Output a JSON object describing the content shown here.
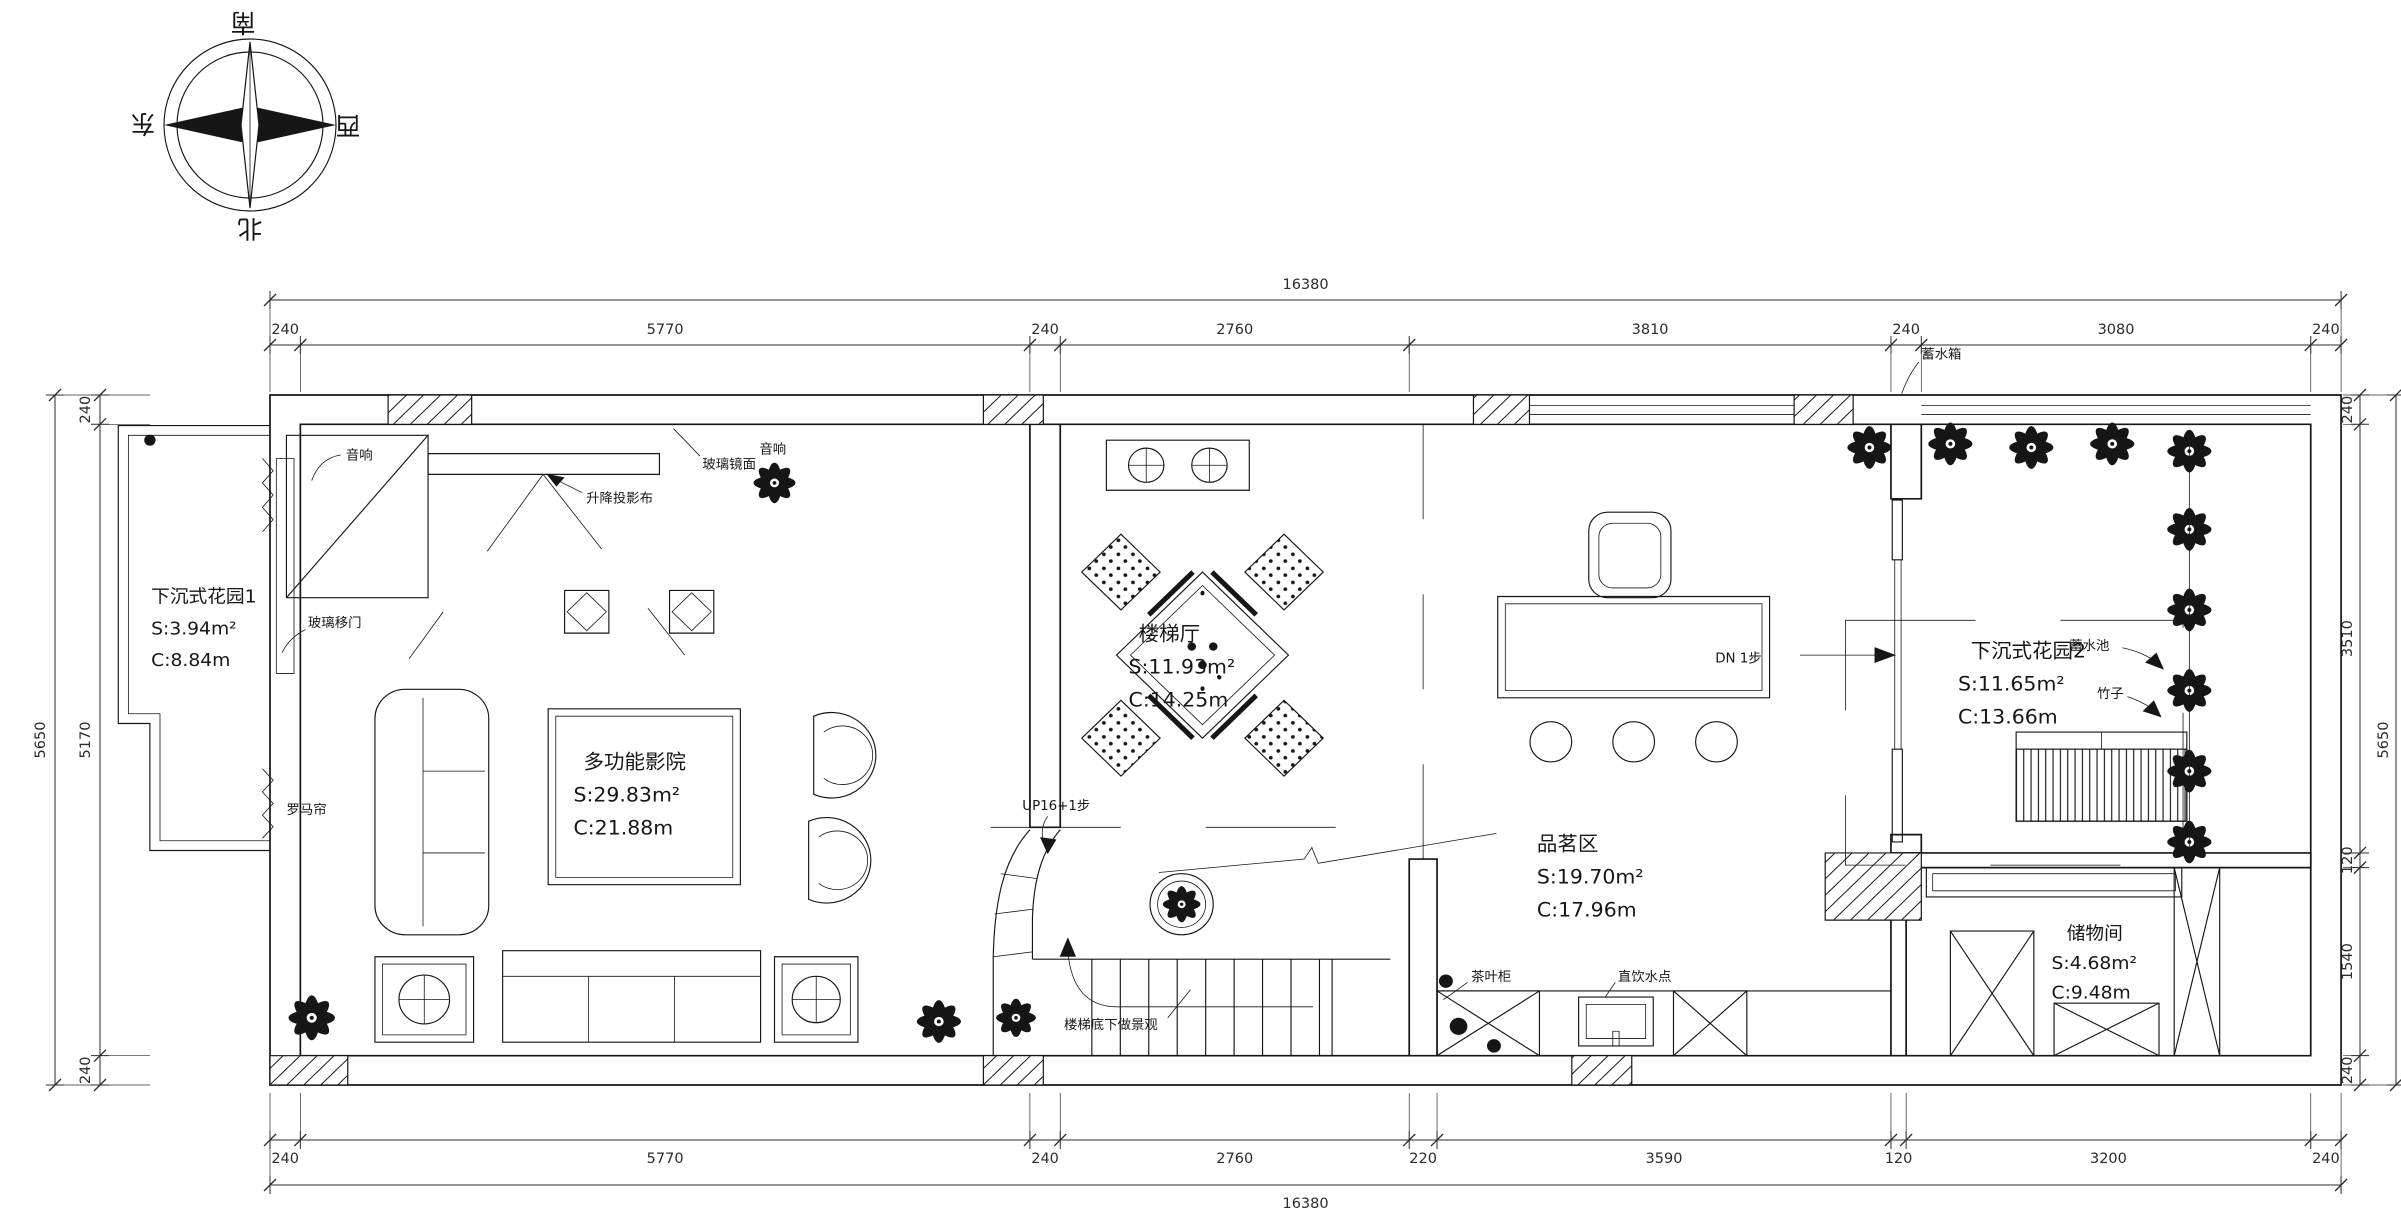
{
  "compass": {
    "south": "南",
    "north": "北",
    "east": "东",
    "west": "西"
  },
  "dimensions": {
    "top": {
      "total": 16380,
      "segments": [
        240,
        5770,
        240,
        2760,
        3810,
        240,
        3080,
        240
      ]
    },
    "bottom": {
      "total": 16380,
      "segments": [
        240,
        5770,
        240,
        2760,
        220,
        3590,
        120,
        3200,
        240
      ]
    },
    "left": {
      "total": 5650,
      "segments": [
        240,
        5170,
        240
      ]
    },
    "right": {
      "total": 5650,
      "segments": [
        240,
        3510,
        120,
        1540,
        240
      ]
    }
  },
  "rooms": {
    "garden1": {
      "name": "下沉式花园1",
      "area": "S:3.94m²",
      "girth": "C:8.84m"
    },
    "cinema": {
      "name": "多功能影院",
      "area": "S:29.83m²",
      "girth": "C:21.88m"
    },
    "stairhall": {
      "name": "楼梯厅",
      "area": "S:11.93m²",
      "girth": "C:14.25m"
    },
    "tea": {
      "name": "品茗区",
      "area": "S:19.70m²",
      "girth": "C:17.96m"
    },
    "garden2": {
      "name": "下沉式花园2",
      "area": "S:11.65m²",
      "girth": "C:13.66m"
    },
    "storage": {
      "name": "储物间",
      "area": "S:4.68m²",
      "girth": "C:9.48m"
    }
  },
  "annotations": {
    "speaker": "音响",
    "glass_door": "玻璃移门",
    "roman_blind": "罗马帘",
    "projector_screen": "升降投影布",
    "glass_mirror": "玻璃镜面",
    "up_stairs": "UP16+1步",
    "under_stair_landscape": "楼梯底下做景观",
    "dn_step": "DN 1步",
    "tea_cabinet": "茶叶柜",
    "drinking_water": "直饮水点",
    "water_tank": "蓄水箱",
    "water_pool": "蓄水池",
    "bamboo": "竹子"
  }
}
